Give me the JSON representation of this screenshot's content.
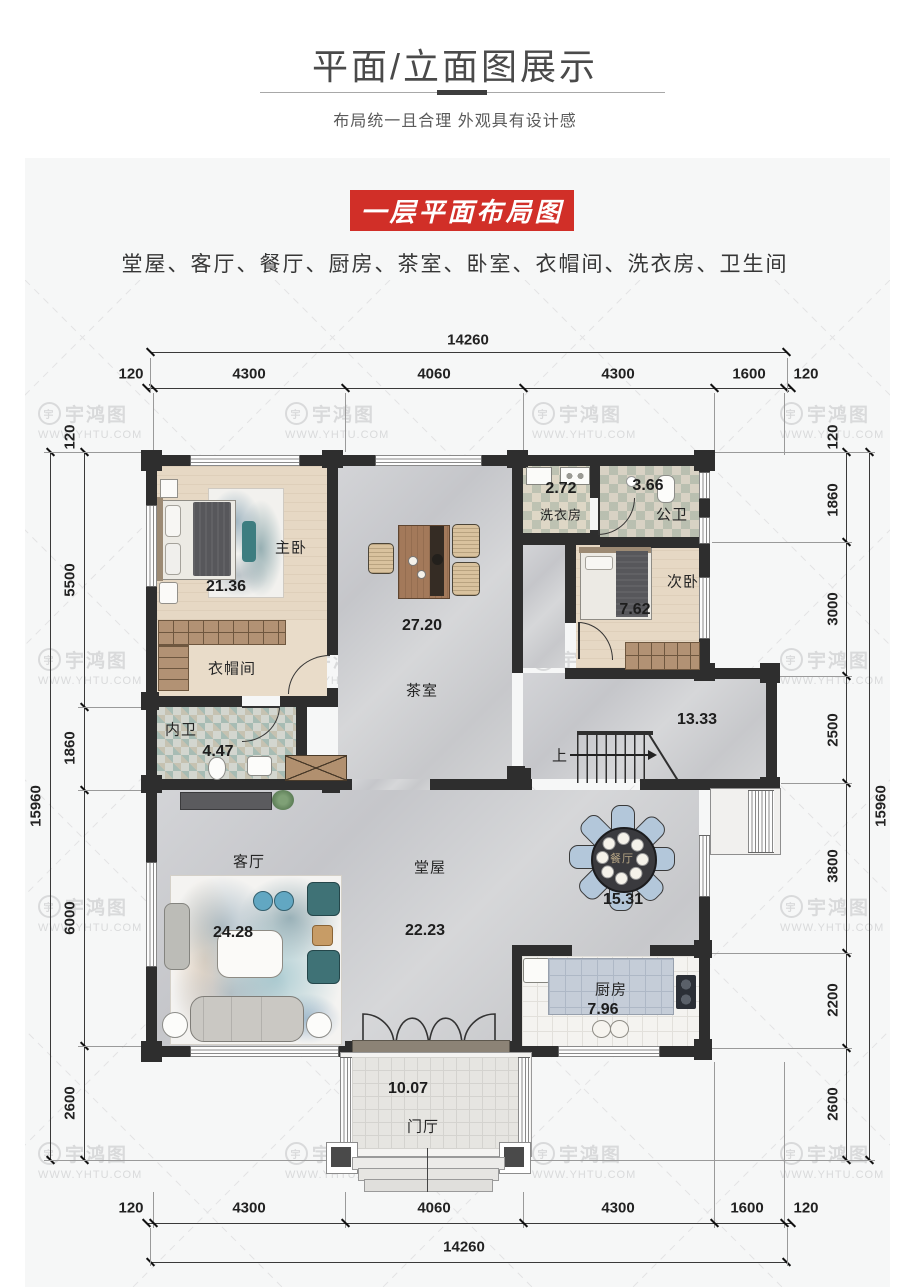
{
  "header": {
    "title": "平面/立面图展示",
    "subtitle": "布局统一且合理 外观具有设计感"
  },
  "section": {
    "banner": "一层平面布局图",
    "room_list": "堂屋、客厅、餐厅、厨房、茶室、卧室、衣帽间、洗衣房、卫生间"
  },
  "watermark": {
    "brand": "宇鸿图",
    "url": "WWW.YHTU.COM",
    "logo_glyph": "宇"
  },
  "colors": {
    "banner_red": "#d12f28",
    "wall": "#2e2e2e"
  },
  "plan": {
    "dims": {
      "top_total": "14260",
      "top_segments": [
        "120",
        "4300",
        "4060",
        "4300",
        "1600",
        "120"
      ],
      "bottom_segments": [
        "120",
        "4300",
        "4060",
        "4300",
        "1600",
        "120"
      ],
      "bottom_total": "14260",
      "left": [
        "120",
        "5500",
        "1860",
        "6000",
        "2600"
      ],
      "left_total": "15960",
      "right": [
        "120",
        "1860",
        "3000",
        "2500",
        "3800",
        "2200",
        "2600"
      ],
      "right_total": "15960"
    },
    "rooms": {
      "master": {
        "name": "主卧",
        "area": "21.36"
      },
      "cloak": {
        "name": "衣帽间"
      },
      "wc_private": {
        "name": "内卫",
        "area": "4.47"
      },
      "tea": {
        "name": "茶室",
        "area": "27.20"
      },
      "laundry": {
        "name": "洗衣房",
        "area": "2.72"
      },
      "wc_public": {
        "name": "公卫",
        "area": "3.66"
      },
      "bedroom2": {
        "name": "次卧",
        "area": "7.62"
      },
      "stair_hall": {
        "area": "13.33"
      },
      "living": {
        "name": "客厅",
        "area": "24.28"
      },
      "hall": {
        "name": "堂屋",
        "area": "22.23"
      },
      "dining": {
        "name": "餐厅",
        "area": "15.31"
      },
      "kitchen": {
        "name": "厨房",
        "area": "7.96"
      },
      "porch": {
        "name": "门厅",
        "area": "10.07"
      },
      "stairs_up_label": "上"
    }
  }
}
